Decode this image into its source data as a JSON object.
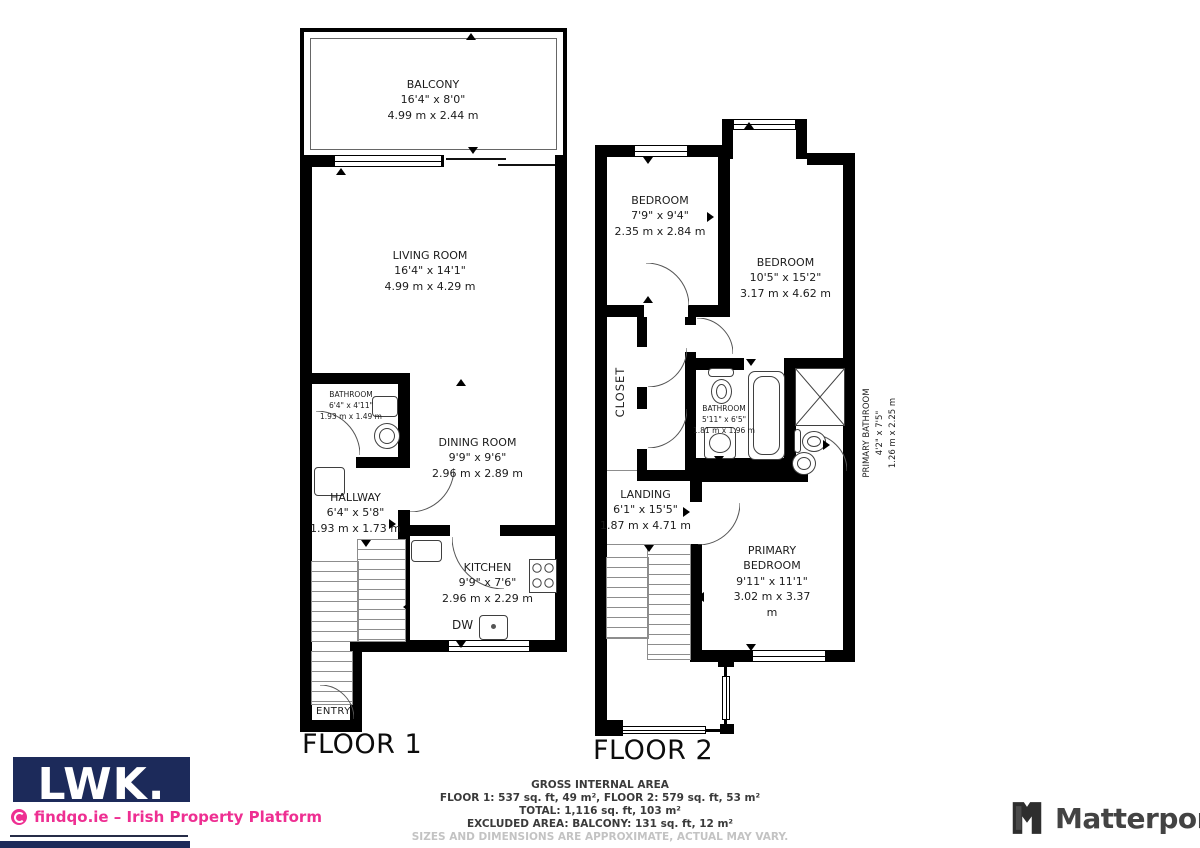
{
  "floor1": {
    "label": "FLOOR 1",
    "balcony": {
      "name": "BALCONY",
      "ft": "16'4\" x 8'0\"",
      "m": "4.99 m x 2.44 m"
    },
    "living_room": {
      "name": "LIVING ROOM",
      "ft": "16'4\" x 14'1\"",
      "m": "4.99 m x 4.29 m"
    },
    "bathroom": {
      "name": "BATHROOM",
      "ft": "6'4\" x 4'11\"",
      "m": "1.93 m x 1.49 m"
    },
    "dining_room": {
      "name": "DINING ROOM",
      "ft": "9'9\" x 9'6\"",
      "m": "2.96 m x 2.89 m"
    },
    "hallway": {
      "name": "HALLWAY",
      "ft": "6'4\" x 5'8\"",
      "m": "1.93 m x 1.73 m"
    },
    "kitchen": {
      "name": "KITCHEN",
      "ft": "9'9\" x 7'6\"",
      "m": "2.96 m x 2.29 m"
    },
    "dishwasher_label": "DW",
    "entry_label": "ENTRY"
  },
  "floor2": {
    "label": "FLOOR 2",
    "bedroom_small": {
      "name": "BEDROOM",
      "ft": "7'9\" x 9'4\"",
      "m": "2.35 m x 2.84 m"
    },
    "bedroom_large": {
      "name": "BEDROOM",
      "ft": "10'5\" x 15'2\"",
      "m": "3.17 m x 4.62 m"
    },
    "closet_label": "CLOSET",
    "bathroom": {
      "name": "BATHROOM",
      "ft": "5'11\" x 6'5\"",
      "m": "1.81 m x 1.96 m"
    },
    "primary_bathroom": {
      "name": "PRIMARY BATHROOM",
      "ft": "4'2\" x 7'5\"",
      "m": "1.26 m x 2.25 m"
    },
    "landing": {
      "name": "LANDING",
      "ft": "6'1\" x 15'5\"",
      "m": "1.87 m x 4.71 m"
    },
    "primary_bedroom": {
      "name": "PRIMARY BEDROOM",
      "ft": "9'11\" x 11'1\"",
      "m": "3.02 m x 3.37 m"
    }
  },
  "summary": {
    "title": "GROSS INTERNAL AREA",
    "floors": "FLOOR 1: 537 sq. ft, 49 m², FLOOR 2: 579 sq. ft, 53 m²",
    "total": "TOTAL: 1,116 sq. ft, 103 m²",
    "excluded": "EXCLUDED AREA: BALCONY: 131 sq. ft, 12 m²",
    "disclaimer": "SIZES AND DIMENSIONS ARE APPROXIMATE, ACTUAL MAY VARY."
  },
  "branding": {
    "agent_logo": "LWK.",
    "platform": "findqo.ie – Irish Property Platform",
    "provider": "Matterport"
  },
  "colors": {
    "wall": "#000000",
    "agent_navy": "#1c2a5a",
    "platform_pink": "#ee2f92",
    "provider_gray": "#434343",
    "disclaimer_gray": "#c3c3c3"
  }
}
